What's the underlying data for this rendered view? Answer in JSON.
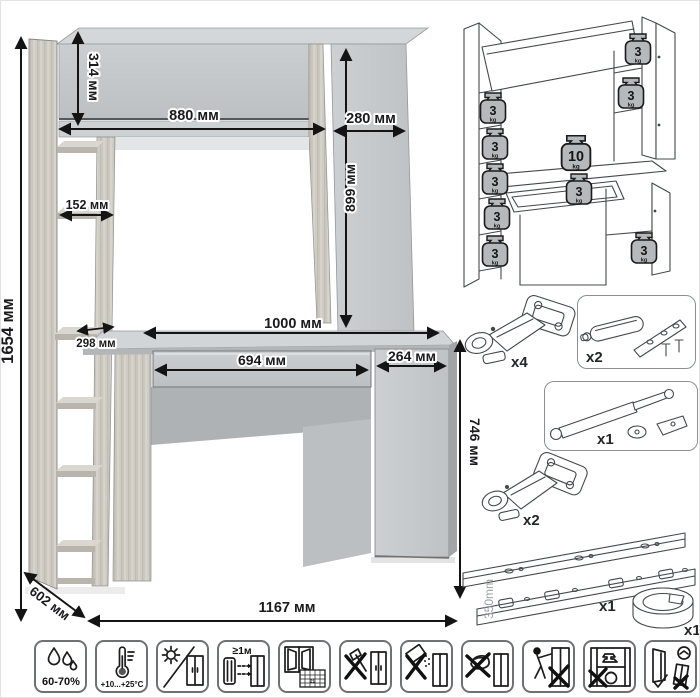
{
  "main_diagram": {
    "dims": {
      "total_height": "1654 мм",
      "top_depth": "314 мм",
      "top_width": "880 мм",
      "side_width": "280 мм",
      "niche_height": "899 мм",
      "shelf_width": "152 мм",
      "desktop_width": "1000 мм",
      "shelf_depth": "298 мм",
      "drawer_width": "694 мм",
      "door_width": "264 мм",
      "desk_height": "746 мм",
      "depth": "602 мм",
      "total_width": "1167 мм"
    }
  },
  "load_diagram": {
    "weights": [
      {
        "location": "left-shelf-1",
        "value": "3",
        "unit": "kg"
      },
      {
        "location": "left-shelf-2",
        "value": "3",
        "unit": "kg"
      },
      {
        "location": "left-shelf-3",
        "value": "3",
        "unit": "kg"
      },
      {
        "location": "left-shelf-4",
        "value": "3",
        "unit": "kg"
      },
      {
        "location": "left-shelf-5",
        "value": "3",
        "unit": "kg"
      },
      {
        "location": "top-cabinet",
        "value": "3",
        "unit": "kg"
      },
      {
        "location": "right-shelf",
        "value": "3",
        "unit": "kg"
      },
      {
        "location": "desktop",
        "value": "10",
        "unit": "kg"
      },
      {
        "location": "drawer",
        "value": "3",
        "unit": "kg"
      },
      {
        "location": "lower-cabinet",
        "value": "3",
        "unit": "kg"
      }
    ]
  },
  "hardware": {
    "items": [
      {
        "name": "concealed-hinge",
        "qty": "x4"
      },
      {
        "name": "door-damper",
        "qty": "x2"
      },
      {
        "name": "gas-lift",
        "qty": "x1"
      },
      {
        "name": "concealed-hinge",
        "qty": "x2"
      },
      {
        "name": "drawer-slides",
        "qty": "x1",
        "length": "350mm"
      },
      {
        "name": "cable-grommet",
        "qty": "x1"
      }
    ]
  },
  "care_icons": {
    "humidity": "60-70%",
    "temperature": "+10...+25°C",
    "heater_distance": "≥1м",
    "calendar_day": "21",
    "items": [
      "humidity-icon",
      "temperature-icon",
      "no-direct-sunlight-icon",
      "heater-distance-icon",
      "ventilation-icon",
      "no-sharp-tools-icon",
      "no-abrasive-cleaners-icon",
      "no-wet-cleaning-icon",
      "no-dragging-icon",
      "no-overload-icon",
      "secure-installation-icon"
    ]
  },
  "colors": {
    "panel_gray": "#c3c6c8",
    "panel_light": "#d2d5d7",
    "panel_dark": "#aeb1b3",
    "wood_light": "#cfccc4",
    "wood_dark": "#bdb8ad",
    "dimension_line": "#141414",
    "wireframe": "#45484b",
    "weight_fill": "#b6b9bb",
    "icon_border": "#6e7275"
  }
}
